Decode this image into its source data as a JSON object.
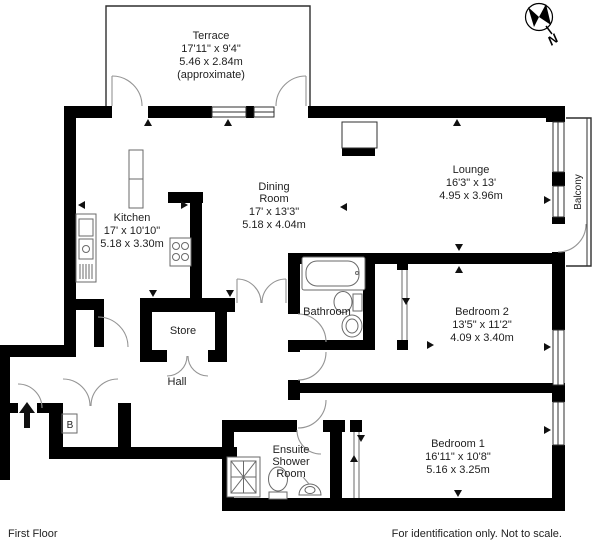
{
  "page": {
    "floor_label": "First Floor",
    "disclaimer": "For identification only. Not to scale."
  },
  "compass": {
    "north_label": "N"
  },
  "annotations": {
    "boiler_label": "B"
  },
  "rooms": {
    "terrace": {
      "name": "Terrace",
      "imperial": "17'11\" x 9'4\"",
      "metric": "5.46 x 2.84m",
      "note": "(approximate)"
    },
    "lounge": {
      "name": "Lounge",
      "imperial": "16'3\" x 13'",
      "metric": "4.95 x 3.96m"
    },
    "balcony": {
      "name": "Balcony"
    },
    "kitchen": {
      "name": "Kitchen",
      "imperial": "17' x 10'10\"",
      "metric": "5.18 x 3.30m"
    },
    "dining_room": {
      "name_line1": "Dining",
      "name_line2": "Room",
      "imperial": "17' x 13'3\"",
      "metric": "5.18 x 4.04m"
    },
    "bathroom": {
      "name": "Bathroom"
    },
    "bedroom2": {
      "name": "Bedroom 2",
      "imperial": "13'5\" x 11'2\"",
      "metric": "4.09 x 3.40m"
    },
    "store": {
      "name": "Store"
    },
    "hall": {
      "name": "Hall"
    },
    "ensuite": {
      "name_line1": "Ensuite",
      "name_line2": "Shower",
      "name_line3": "Room"
    },
    "bedroom1": {
      "name": "Bedroom 1",
      "imperial": "16'11\" x 10'8\"",
      "metric": "5.16 x 3.25m"
    }
  },
  "colors": {
    "wall": "#000000",
    "door_line": "#949494",
    "fixture_line": "#6a6a6a",
    "text": "#1f1f1f",
    "background": "#ffffff"
  }
}
